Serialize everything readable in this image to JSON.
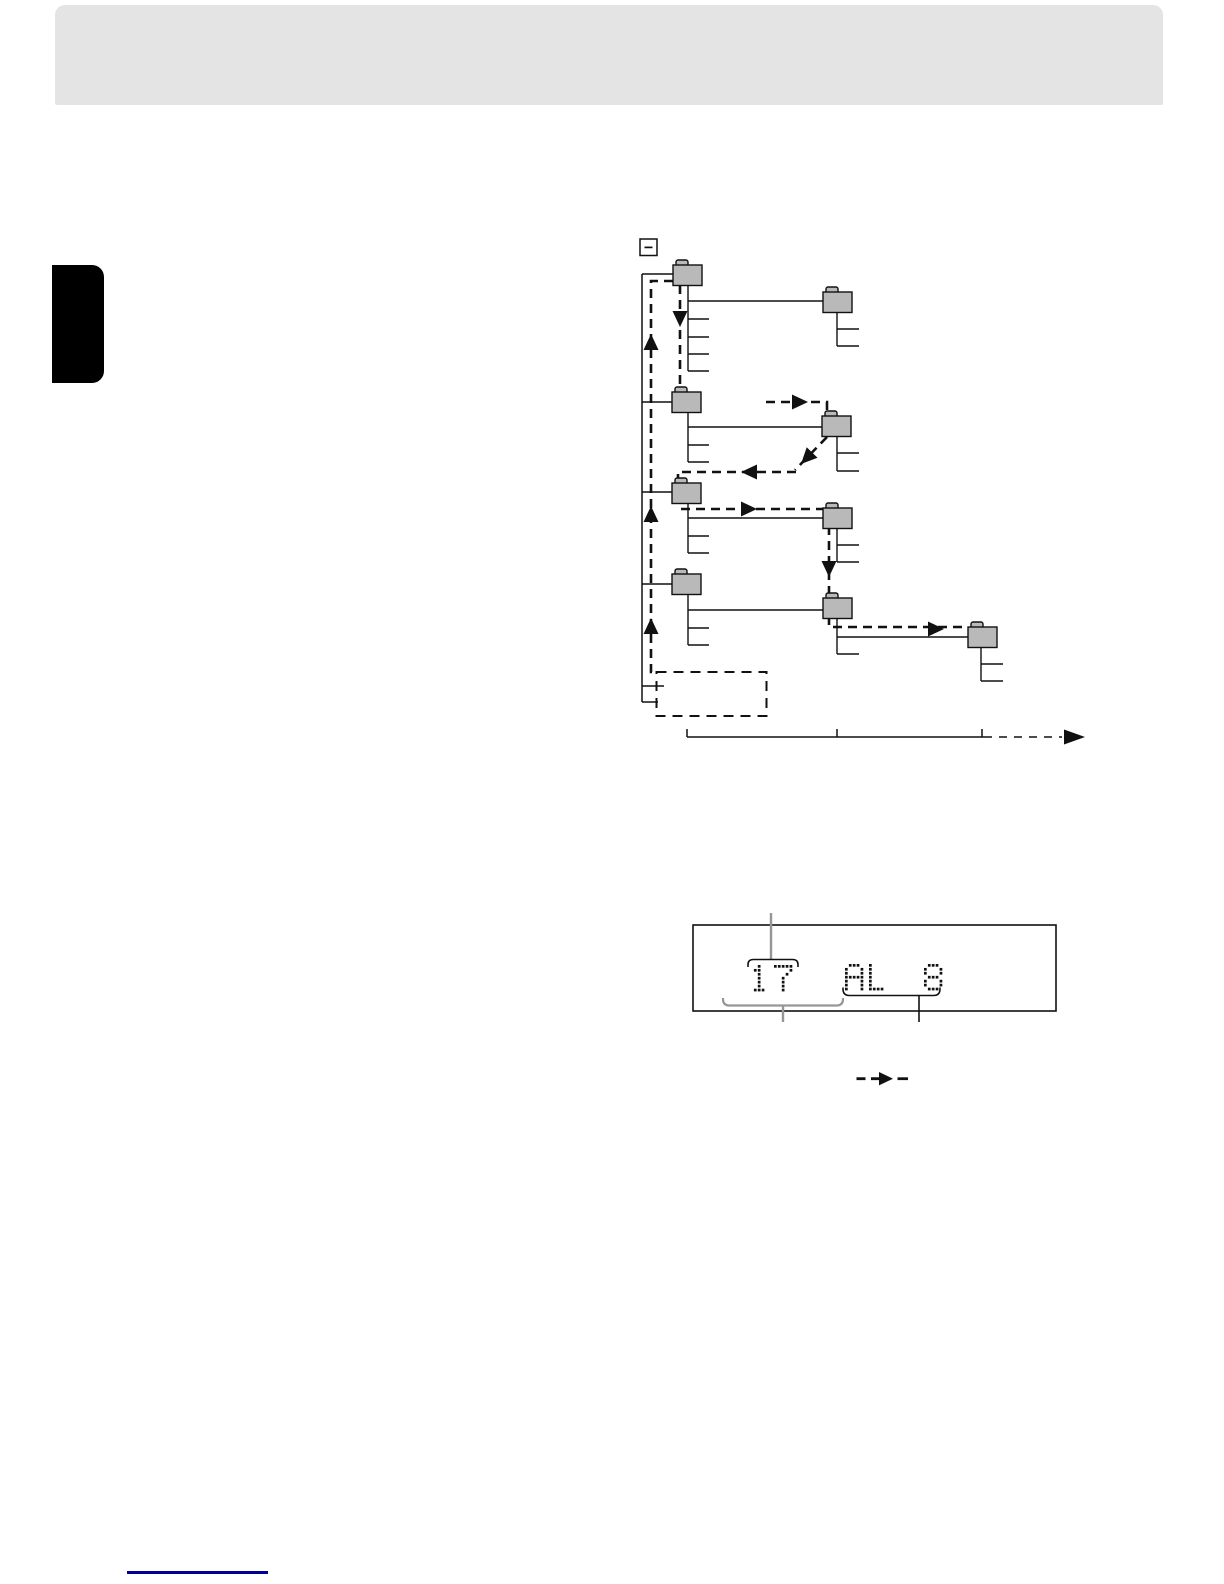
{
  "colors": {
    "page_bg": "#ffffff",
    "header_gray": "#e4e4e4",
    "tab_black": "#000000",
    "line": "#111111",
    "folder_fill": "#b9b9b9",
    "callout_gray": "#969696",
    "link_blue": "#000099"
  },
  "header": {
    "title": ""
  },
  "diagram": {
    "root_icon": "collapse-minus-icon",
    "folders": [
      {
        "id": "album-1",
        "x": 673,
        "y": 265
      },
      {
        "id": "album-1-sub",
        "x": 823,
        "y": 292
      },
      {
        "id": "album-2",
        "x": 672,
        "y": 392
      },
      {
        "id": "album-2-sub",
        "x": 822,
        "y": 416
      },
      {
        "id": "album-3",
        "x": 672,
        "y": 483
      },
      {
        "id": "album-3-sub",
        "x": 823,
        "y": 508
      },
      {
        "id": "album-4",
        "x": 672,
        "y": 574
      },
      {
        "id": "album-4-sub",
        "x": 823,
        "y": 598
      },
      {
        "id": "album-4-sub-sub",
        "x": 968,
        "y": 627
      }
    ]
  },
  "display": {
    "value": "17 AL 8",
    "segments": [
      {
        "text": "17",
        "x": 750,
        "y": 965
      },
      {
        "text": "AL",
        "x": 845,
        "y": 964
      },
      {
        "text": "8",
        "x": 924,
        "y": 964
      }
    ]
  },
  "legend": {
    "dashed_arrow_icon": "playback-order-dashed-arrow"
  }
}
